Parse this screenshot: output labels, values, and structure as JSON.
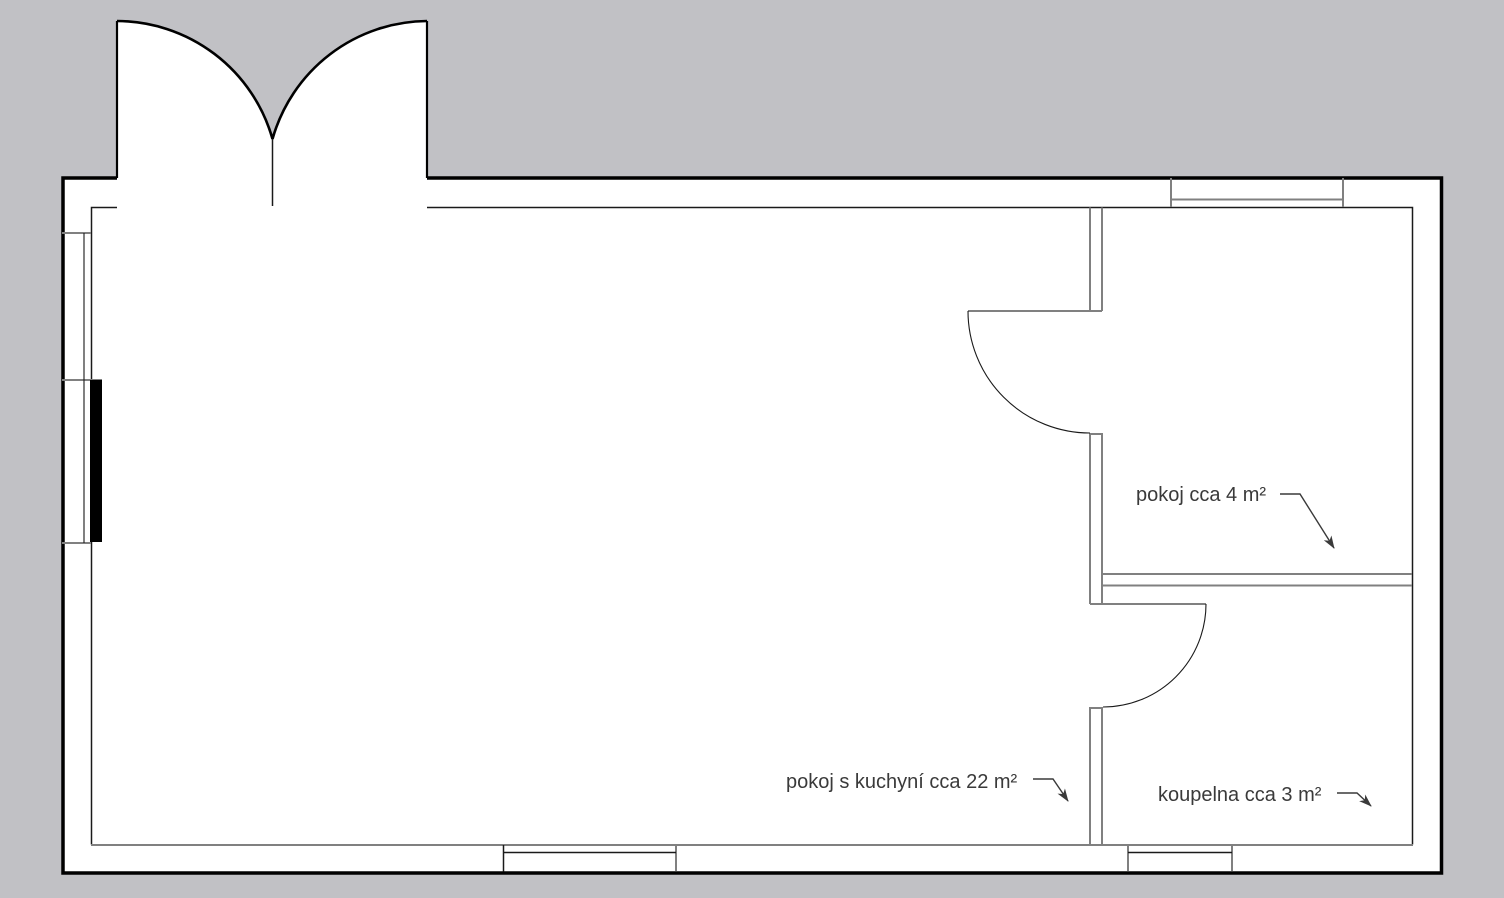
{
  "canvas": {
    "background_color": "#c1c1c5",
    "plan_fill": "#ffffff",
    "outline_color": "#000000",
    "wall_line_color": "#808080",
    "detail_line_color": "#1a1a1a",
    "annotation_color": "#3a3a3a"
  },
  "labels": {
    "room_main": "pokoj s kuchyní cca 22 m²",
    "room_small": "pokoj cca 4 m²",
    "bathroom": "koupelna cca 3 m²"
  }
}
